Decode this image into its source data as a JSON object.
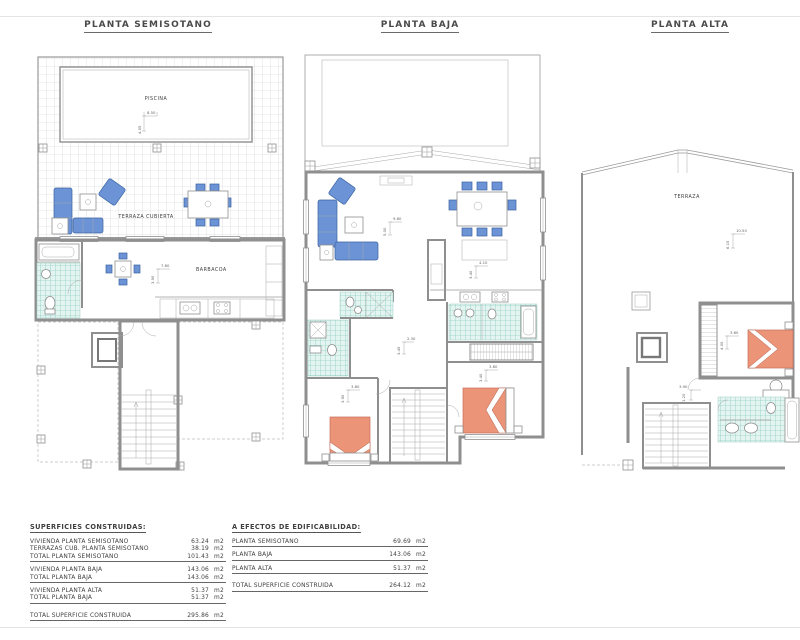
{
  "plans": {
    "semisotano": {
      "title": "PLANTA SEMISOTANO",
      "labels": {
        "piscina": "PISCINA",
        "terraza_cubierta": "TERRAZA CUBIERTA",
        "barbacoa": "BARBACOA"
      },
      "dims": {
        "pool_w": "8.50",
        "pool_h": "4.05",
        "salon_w": "7.80",
        "salon_h": "3.90"
      }
    },
    "baja": {
      "title": "PLANTA BAJA",
      "dims": {
        "salon_w": "9.80",
        "salon_h": "5.00",
        "cocina_w": "4.10",
        "cocina_h": "3.40",
        "pasillo_w": "2.30",
        "pasillo_h": "3.45",
        "dorm1_w": "3.80",
        "dorm1_h": "3.90",
        "dorm2_w": "3.80",
        "dorm2_h": "3.40"
      }
    },
    "alta": {
      "title": "PLANTA ALTA",
      "labels": {
        "terraza": "TERRAZA"
      },
      "dims": {
        "terraza_w": "10.50",
        "terraza_h": "6.15",
        "dorm_w": "3.60",
        "dorm_h": "4.00",
        "pasillo_w": "3.90",
        "pasillo_h": "1.20"
      }
    }
  },
  "tables": {
    "superficies": {
      "title": "SUPERFICIES CONSTRUIDAS:",
      "rows": [
        {
          "label": "VIVIENDA PLANTA SEMISOTANO",
          "value": "63.24",
          "unit": "m2"
        },
        {
          "label": "TERRAZAS CUB. PLANTA SEMISOTANO",
          "value": "38.19",
          "unit": "m2"
        },
        {
          "label": "TOTAL PLANTA SEMISOTANO",
          "value": "101.43",
          "unit": "m2"
        },
        {
          "label": "VIVIENDA PLANTA BAJA",
          "value": "143.06",
          "unit": "m2"
        },
        {
          "label": "TOTAL PLANTA BAJA",
          "value": "143.06",
          "unit": "m2"
        },
        {
          "label": "VIVIENDA PLANTA ALTA",
          "value": "51.37",
          "unit": "m2"
        },
        {
          "label": "TOTAL PLANTA BAJA",
          "value": "51.37",
          "unit": "m2"
        },
        {
          "label": "TOTAL SUPERFICIE CONSTRUIDA",
          "value": "295.86",
          "unit": "m2"
        }
      ]
    },
    "edificabilidad": {
      "title": "A EFECTOS DE EDIFICABILIDAD:",
      "rows": [
        {
          "label": "PLANTA SEMISOTANO",
          "value": "69.69",
          "unit": "m2"
        },
        {
          "label": "PLANTA BAJA",
          "value": "143.06",
          "unit": "m2"
        },
        {
          "label": "PLANTA ALTA",
          "value": "51.37",
          "unit": "m2"
        },
        {
          "label": "TOTAL SUPERFICIE CONSTRUIDA",
          "value": "264.12",
          "unit": "m2"
        }
      ]
    }
  },
  "colors": {
    "furniture_blue": "#6b93d6",
    "bed_orange": "#ec9478",
    "bath_teal": "#6fc2b2",
    "wall_gray": "#8f8f8f"
  }
}
